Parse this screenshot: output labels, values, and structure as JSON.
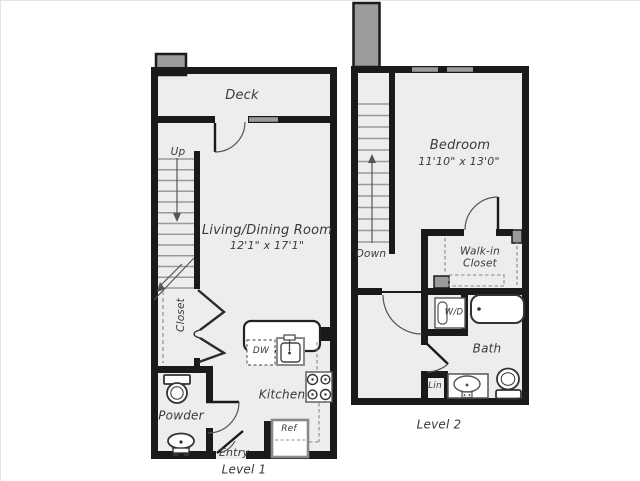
{
  "title": "Two-level apartment floor plan",
  "colors": {
    "wall": "#1a1a1a",
    "floor_fill": "#ededed",
    "accent_gray": "#9b9b9b",
    "tread_gray": "#9a9a9a",
    "text": "#3a3a3a"
  },
  "level1": {
    "label": "Level 1",
    "deck": "Deck",
    "up": "Up",
    "living_dining": "Living/Dining Room",
    "living_dining_dims": "12'1\" x 17'1\"",
    "closet": "Closet",
    "powder": "Powder",
    "kitchen": "Kitchen",
    "dw": "DW",
    "ref": "Ref",
    "entry": "Entry"
  },
  "level2": {
    "label": "Level 2",
    "bedroom": "Bedroom",
    "bedroom_dims": "11'10\" x 13'0\"",
    "down": "Down",
    "walk_in_closet": "Walk-in Closet",
    "wd": "W/D",
    "bath": "Bath",
    "lin": "Lin"
  }
}
